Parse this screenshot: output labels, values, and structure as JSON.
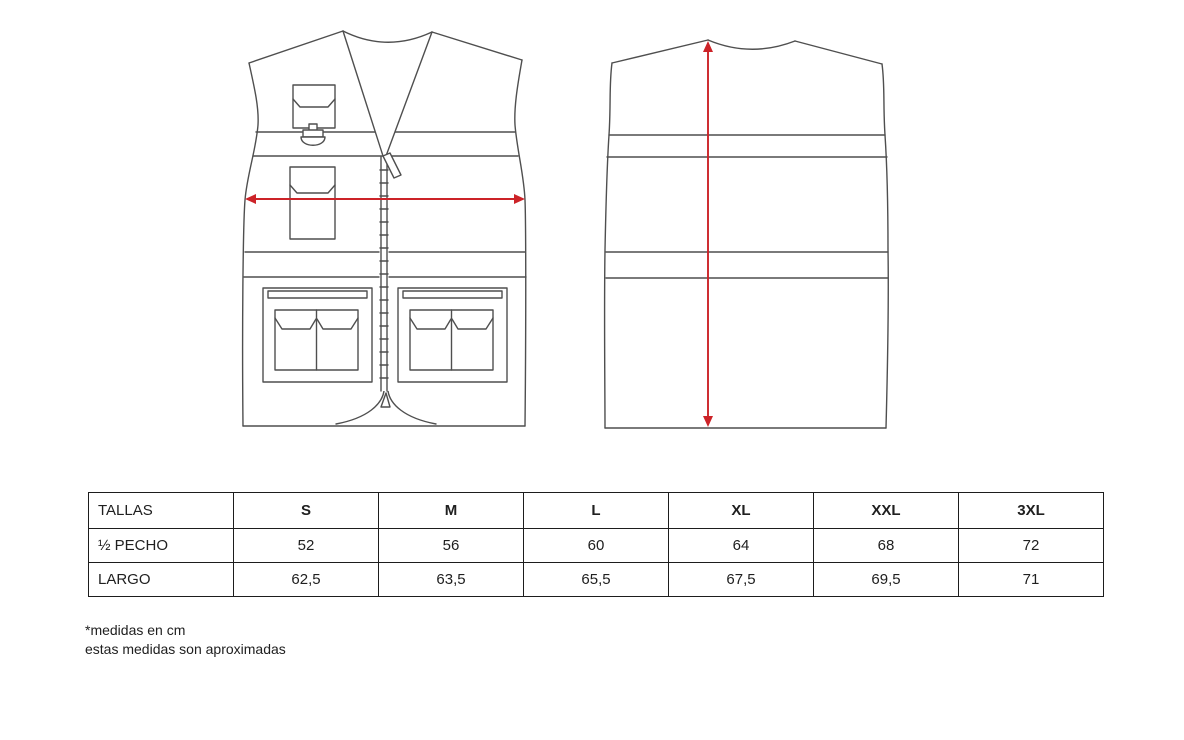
{
  "colors": {
    "outline": "#4f4f4f",
    "measure_arrow": "#cc2328",
    "table_border": "#1d1d1d",
    "text": "#202020",
    "background": "#ffffff"
  },
  "diagram": {
    "front_view": "vest-front-view",
    "back_view": "vest-back-view",
    "chest_arrow": "half-chest-measure-arrow",
    "length_arrow": "length-measure-arrow"
  },
  "size_table": {
    "header_label": "TALLAS",
    "sizes": [
      "S",
      "M",
      "L",
      "XL",
      "XXL",
      "3XL"
    ],
    "rows": [
      {
        "label": "½ PECHO",
        "values": [
          "52",
          "56",
          "60",
          "64",
          "68",
          "72"
        ]
      },
      {
        "label": "LARGO",
        "values": [
          "62,5",
          "63,5",
          "65,5",
          "67,5",
          "69,5",
          "71"
        ]
      }
    ]
  },
  "footnote": {
    "line1": "*medidas en cm",
    "line2": "estas medidas son aproximadas"
  }
}
